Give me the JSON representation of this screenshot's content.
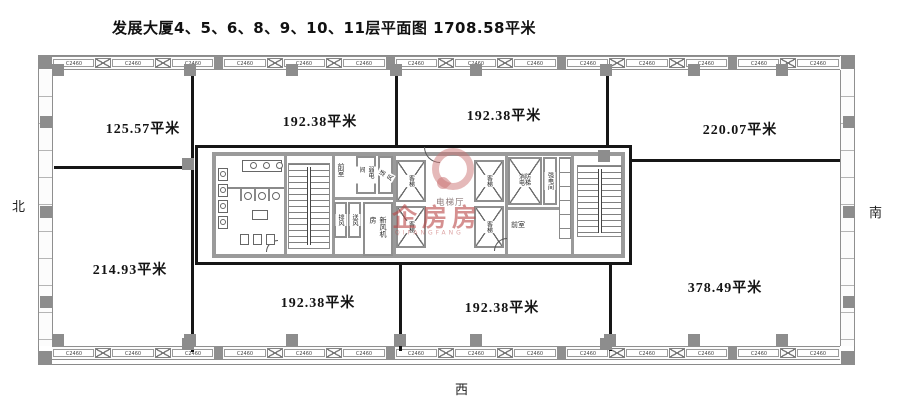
{
  "title": "发展大厦4、5、6、8、9、10、11层平面图 1708.58平米",
  "compass": {
    "north": "北",
    "south": "南",
    "west": "西"
  },
  "rooms": [
    {
      "name": "top-left",
      "area": "125.57平米"
    },
    {
      "name": "top-mid-left",
      "area": "192.38平米"
    },
    {
      "name": "top-mid-right",
      "area": "192.38平米"
    },
    {
      "name": "top-right",
      "area": "220.07平米"
    },
    {
      "name": "bottom-left",
      "area": "214.93平米"
    },
    {
      "name": "bottom-mid-left",
      "area": "192.38平米"
    },
    {
      "name": "bottom-mid-right",
      "area": "192.38平米"
    },
    {
      "name": "bottom-right",
      "area": "378.49平米"
    }
  ],
  "core": {
    "labels": {
      "elevator_hall": "电梯厅",
      "passenger_elevator": "客梯",
      "fire_elevator": "消防电梯",
      "front_room_left": "前室",
      "front_room_right": "前室",
      "fresh_air_room": "新风机房",
      "supply_air": "送风",
      "supply_air_2": "送风",
      "exhaust_air": "排风",
      "weak_electric_room": "弱电间",
      "strong_electric_room": "强电间"
    }
  },
  "windows": {
    "top": [
      "C2460",
      "C2460",
      "C2460",
      "C2460",
      "C2460",
      "C2460",
      "C2460",
      "C2460",
      "C2460",
      "C2460",
      "C2460",
      "C2460",
      "C2460",
      "C2460"
    ],
    "bottom": [
      "C2460",
      "C2460",
      "C2460",
      "C2460",
      "C2460",
      "C2460",
      "C2460",
      "C2460",
      "C2460",
      "C2460",
      "C2460",
      "C2460",
      "C2460",
      "C2460"
    ]
  },
  "watermark": {
    "text": "企房房",
    "subtext": "QIFANGFANG"
  },
  "colors": {
    "wall_black": "#161616",
    "wall_gray": "#9a9a9a",
    "watermark_red": "#b94646"
  }
}
